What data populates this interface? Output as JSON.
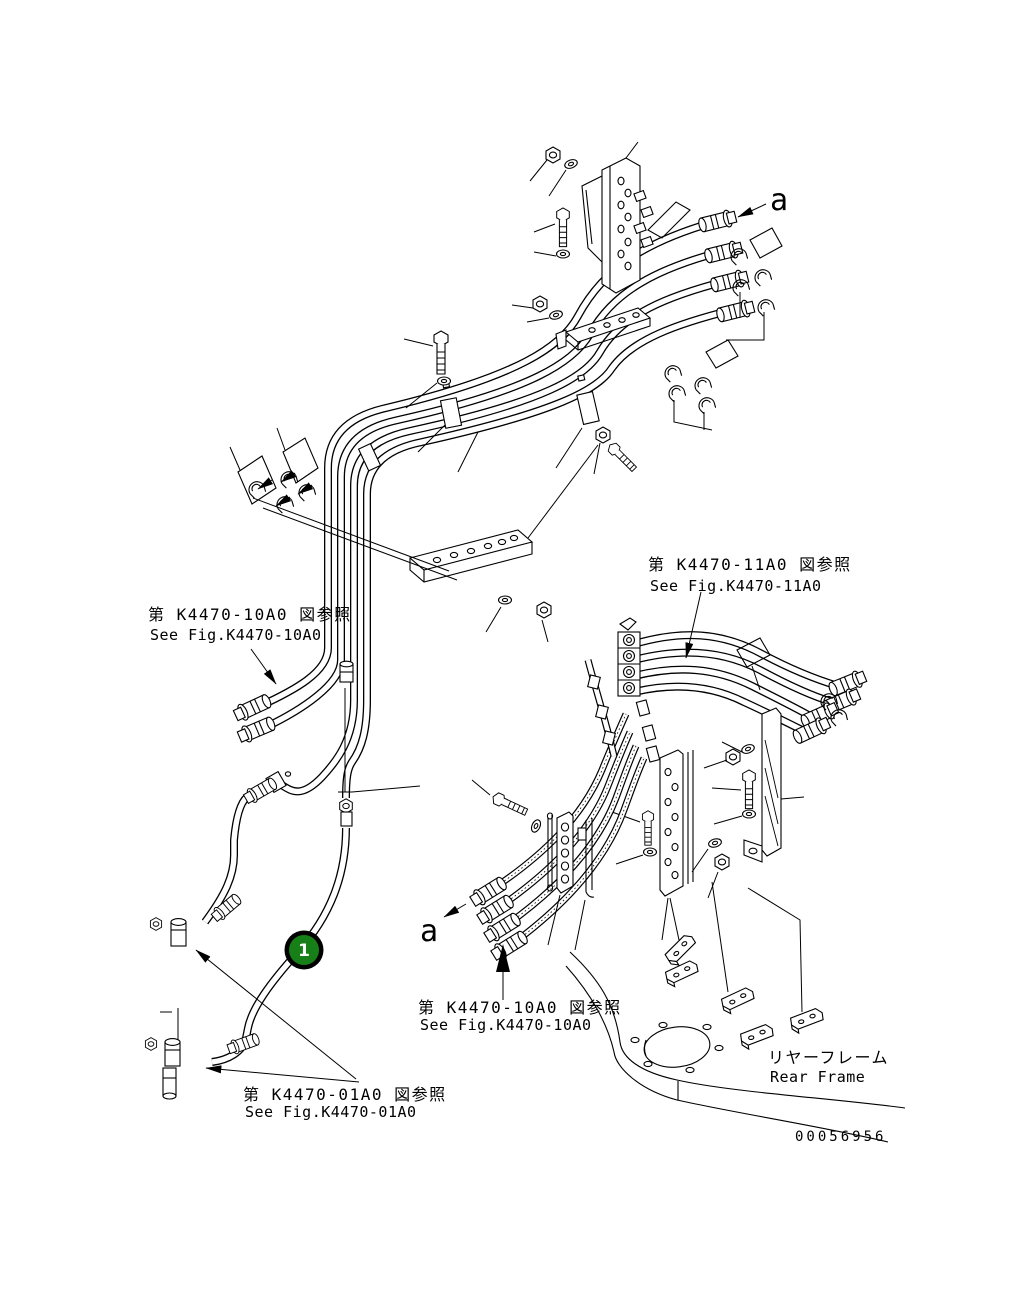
{
  "drawing": {
    "background": "#ffffff",
    "line_color": "#000000",
    "labels": {
      "ref_left_jp": "第 K4470-10A0 図参照",
      "ref_left_en": "See Fig.K4470-10A0",
      "ref_right_jp": "第 K4470-11A0 図参照",
      "ref_right_en": "See Fig.K4470-11A0",
      "ref_bottom_center_jp": "第 K4470-10A0 図参照",
      "ref_bottom_center_en": "See Fig.K4470-10A0",
      "ref_bottom_left_jp": "第 K4470-01A0 図参照",
      "ref_bottom_left_en": "See Fig.K4470-01A0",
      "rear_frame_jp": "リヤーフレーム",
      "rear_frame_en": "Rear Frame",
      "view_arrow_top": "a",
      "view_arrow_bottom": "a"
    },
    "part_number": "00056956",
    "balloon": {
      "number": "1",
      "fill": "#177f17",
      "ring": "#000000",
      "text_color": "#ffffff"
    }
  }
}
